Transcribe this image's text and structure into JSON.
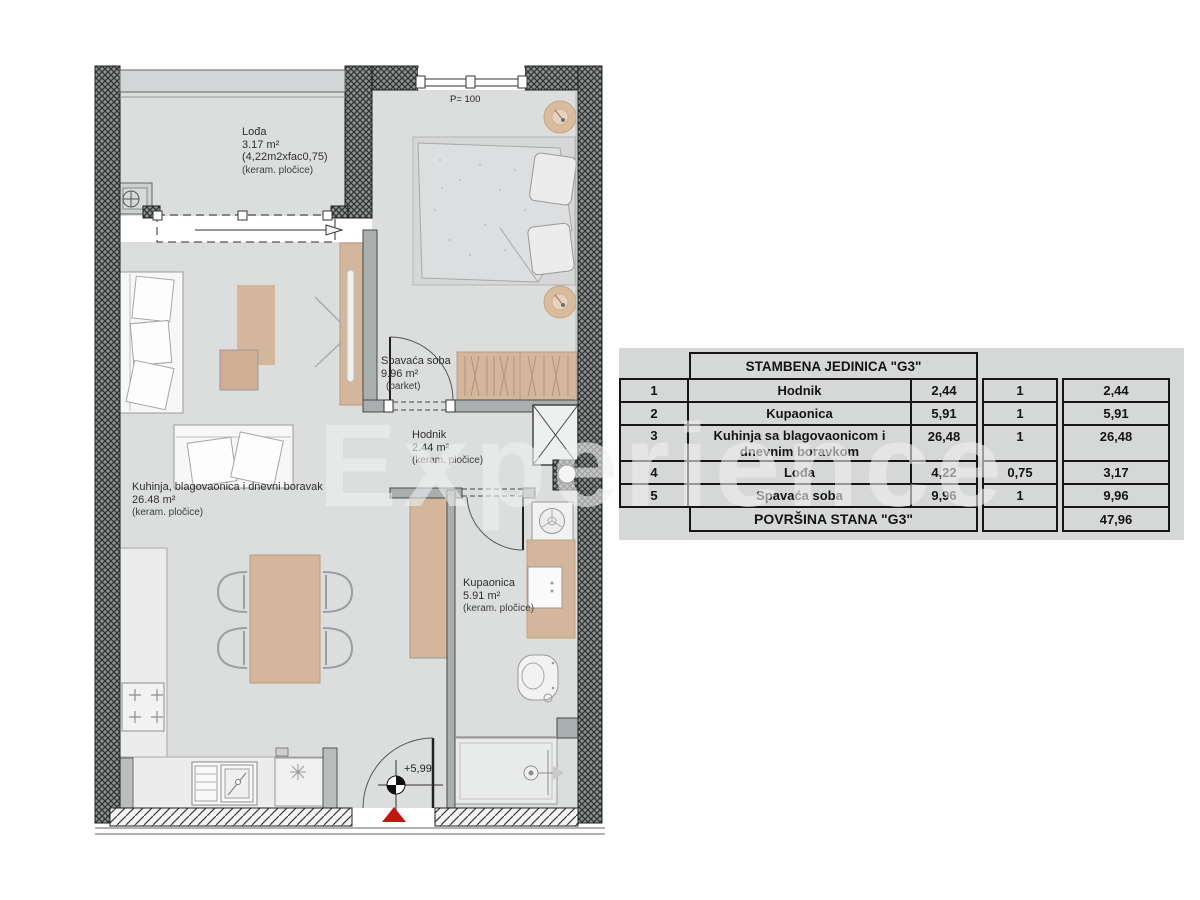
{
  "watermark": "Experience",
  "plan": {
    "window_label": "P= 100",
    "elevation_label": "+5,99",
    "rooms": {
      "lodja": {
        "name": "Lođa",
        "area": "3.17 m²",
        "calc": "(4,22m2xfac0,75)",
        "floor": "(keram. pločice)"
      },
      "spavaca": {
        "name": "Spavaća soba",
        "area": "9.96 m²",
        "floor": "(parket)"
      },
      "kuhinja": {
        "name": "Kuhinja, blagovaonica i dnevni boravak",
        "area": "26.48 m²",
        "floor": "(keram. pločice)"
      },
      "hodnik": {
        "name": "Hodnik",
        "area": "2.44 m²",
        "floor": "(keram. pločice)"
      },
      "kupaonica": {
        "name": "Kupaonica",
        "area": "5.91 m²",
        "floor": "(keram. pločice)"
      }
    }
  },
  "table": {
    "title": "STAMBENA JEDINICA \"G3\"",
    "rows": [
      {
        "num": "1",
        "name": "Hodnik",
        "name2": "",
        "area": "2,44",
        "factor": "1",
        "result": "2,44"
      },
      {
        "num": "2",
        "name": "Kupaonica",
        "name2": "",
        "area": "5,91",
        "factor": "1",
        "result": "5,91"
      },
      {
        "num": "3",
        "name": "Kuhinja sa blagovaonicom i",
        "name2": "dnevnim boravkom",
        "area": "26,48",
        "factor": "1",
        "result": "26,48"
      },
      {
        "num": "4",
        "name": "Lođa",
        "name2": "",
        "area": "4,22",
        "factor": "0,75",
        "result": "3,17"
      },
      {
        "num": "5",
        "name": "Spavaća soba",
        "name2": "",
        "area": "9,96",
        "factor": "1",
        "result": "9,96"
      }
    ],
    "footer_label": "POVRŠINA STANA \"G3\"",
    "footer_total": "47,96"
  },
  "colors": {
    "accent_red": "#c2160f",
    "furniture_tan": "#d4b69c",
    "floor_gray": "#dcdede",
    "wall_dark": "#5a5a5a"
  }
}
